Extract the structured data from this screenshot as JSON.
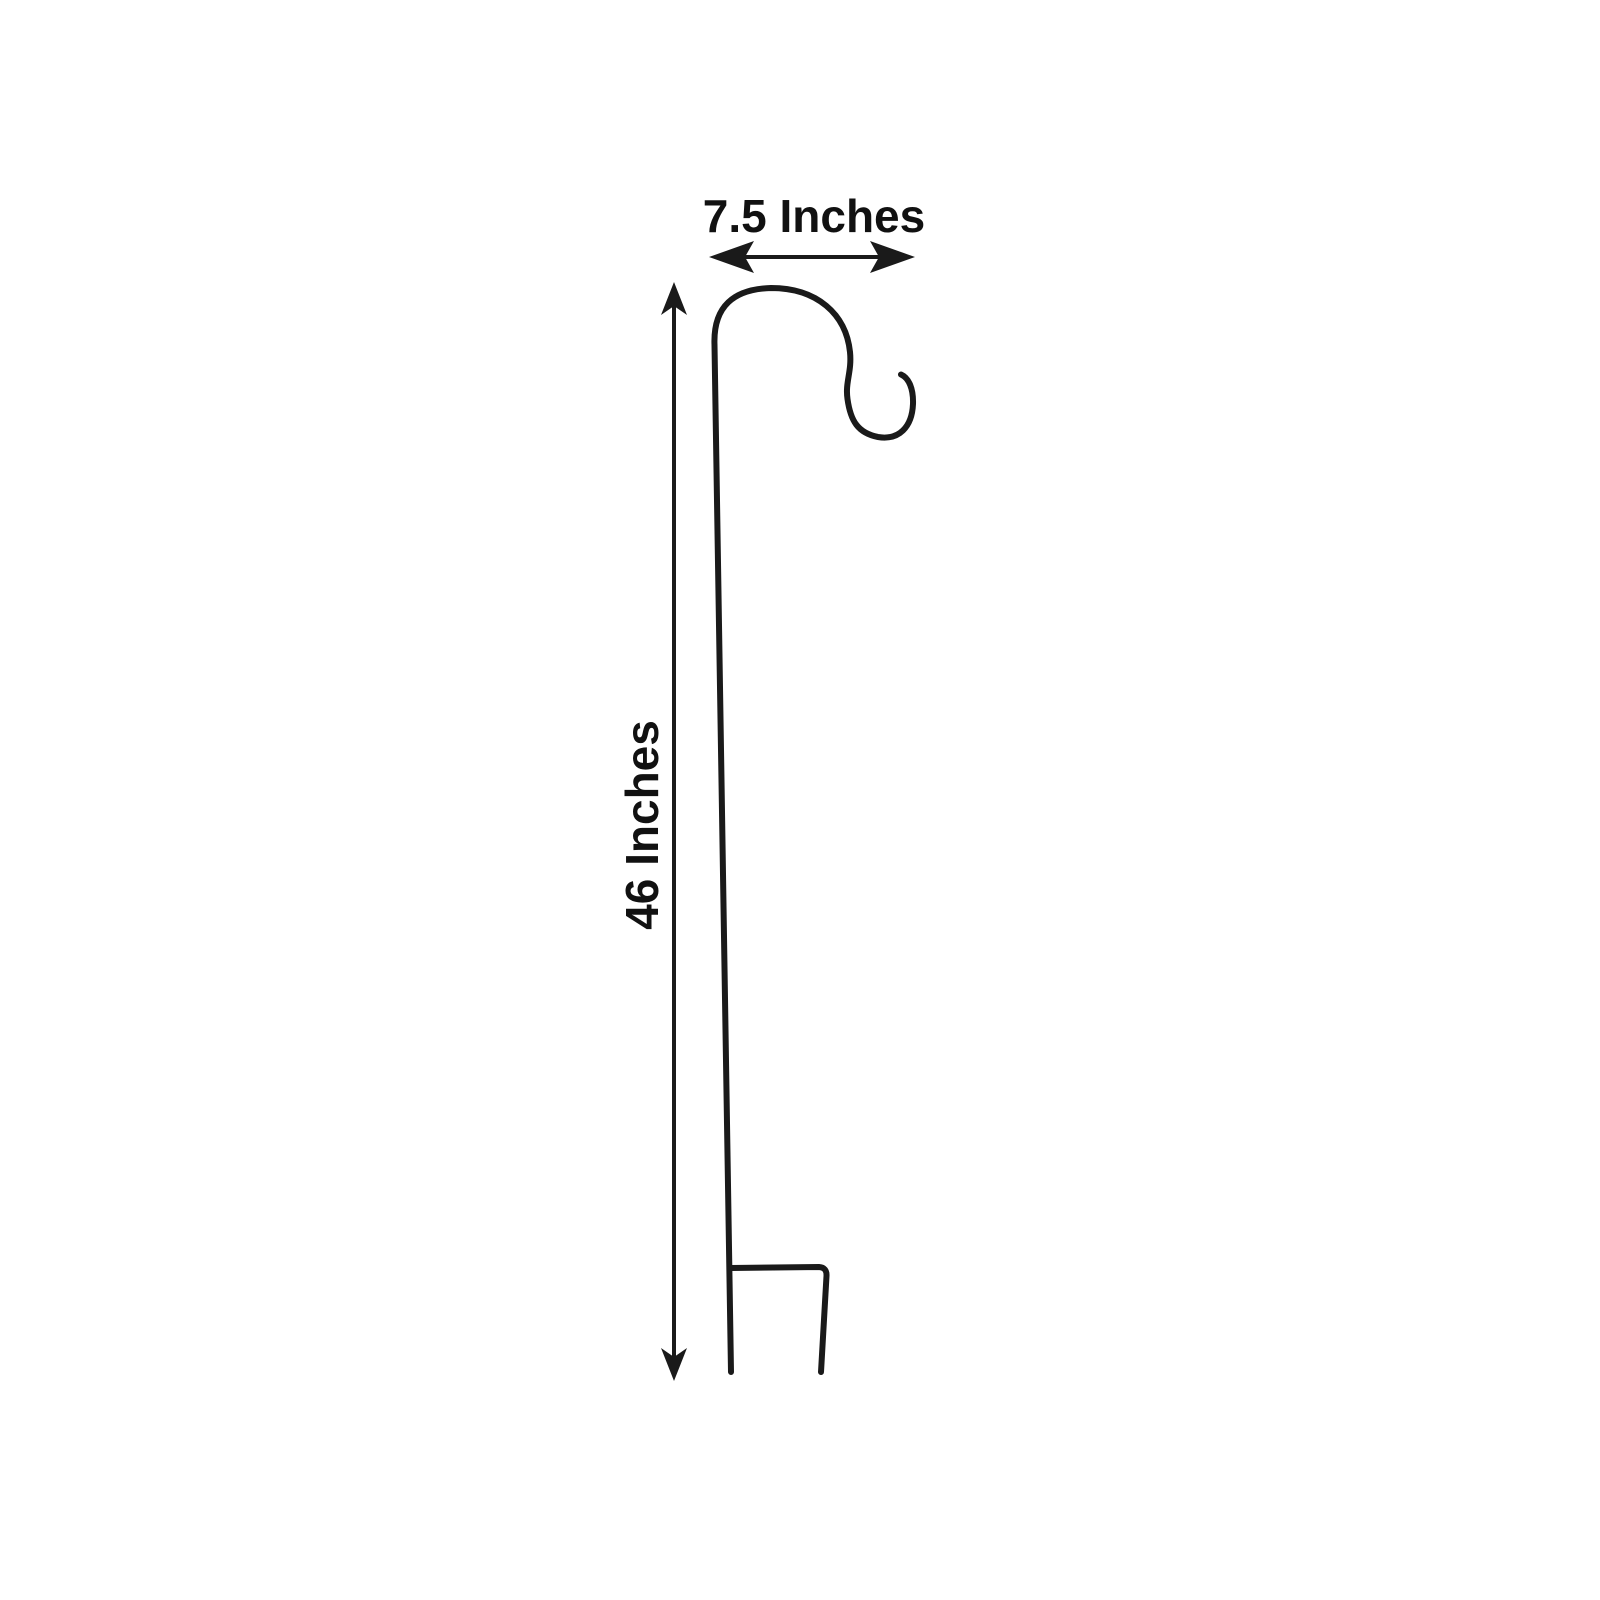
{
  "diagram": {
    "type": "product-dimension-diagram",
    "subject": "shepherd-hook-garden-stake-outline",
    "width_dimension": {
      "label": "7.5 Inches",
      "icon": "left-right-dimension-arrow"
    },
    "height_dimension": {
      "label": "46 Inches",
      "icon": "up-down-dimension-arrow"
    },
    "colors": {
      "line": "#1a1a1a",
      "text": "#111111",
      "bg": "#ffffff"
    }
  }
}
